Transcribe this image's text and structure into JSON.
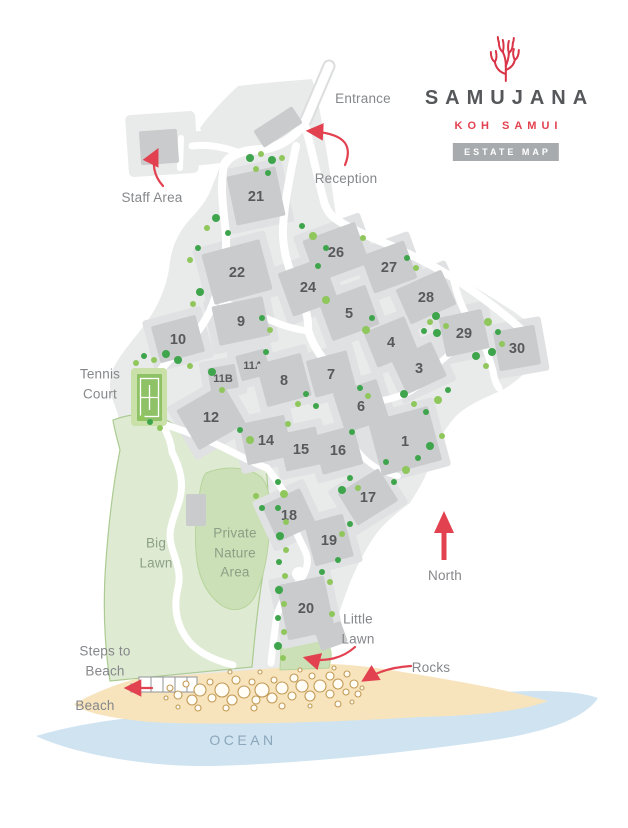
{
  "logo": {
    "brand": "SAMUJANA",
    "location": "KOH SAMUI",
    "badge": "ESTATE MAP"
  },
  "map_labels": {
    "entrance": "Entrance",
    "staff_area": "Staff Area",
    "reception": "Reception",
    "tennis_court": "Tennis Court",
    "big_lawn": "Big Lawn",
    "private_nature_area": "Private Nature Area",
    "little_lawn": "Little Lawn",
    "north": "North",
    "steps_to_beach": "Steps to Beach",
    "beach": "Beach",
    "ocean": "OCEAN",
    "rocks": "Rocks"
  },
  "villas": [
    {
      "number": "21",
      "x": 256,
      "y": 196,
      "w": 50,
      "h": 50,
      "rot": -12
    },
    {
      "number": "22",
      "x": 237,
      "y": 272,
      "w": 60,
      "h": 52,
      "rot": -15
    },
    {
      "number": "26",
      "x": 336,
      "y": 252,
      "w": 56,
      "h": 44,
      "rot": -20
    },
    {
      "number": "27",
      "x": 389,
      "y": 267,
      "w": 46,
      "h": 40,
      "rot": -20
    },
    {
      "number": "24",
      "x": 308,
      "y": 287,
      "w": 48,
      "h": 46,
      "rot": -20
    },
    {
      "number": "28",
      "x": 426,
      "y": 297,
      "w": 50,
      "h": 38,
      "rot": -24
    },
    {
      "number": "5",
      "x": 349,
      "y": 313,
      "w": 50,
      "h": 42,
      "rot": -20
    },
    {
      "number": "9",
      "x": 241,
      "y": 321,
      "w": 52,
      "h": 40,
      "rot": -12
    },
    {
      "number": "10",
      "x": 178,
      "y": 339,
      "w": 46,
      "h": 38,
      "rot": -15
    },
    {
      "number": "4",
      "x": 391,
      "y": 342,
      "w": 44,
      "h": 38,
      "rot": -22
    },
    {
      "number": "29",
      "x": 464,
      "y": 333,
      "w": 44,
      "h": 40,
      "rot": -12
    },
    {
      "number": "30",
      "x": 517,
      "y": 348,
      "w": 42,
      "h": 40,
      "rot": -10
    },
    {
      "number": "11A",
      "x": 253,
      "y": 365,
      "w": 30,
      "h": 26,
      "rot": -15,
      "small": true
    },
    {
      "number": "3",
      "x": 419,
      "y": 368,
      "w": 44,
      "h": 38,
      "rot": -25
    },
    {
      "number": "11B",
      "x": 223,
      "y": 378,
      "w": 28,
      "h": 24,
      "rot": -10,
      "small": true
    },
    {
      "number": "8",
      "x": 284,
      "y": 380,
      "w": 46,
      "h": 44,
      "rot": -15
    },
    {
      "number": "7",
      "x": 331,
      "y": 374,
      "w": 42,
      "h": 38,
      "rot": -15
    },
    {
      "number": "12",
      "x": 211,
      "y": 417,
      "w": 54,
      "h": 46,
      "rot": -30
    },
    {
      "number": "6",
      "x": 361,
      "y": 406,
      "w": 46,
      "h": 42,
      "rot": -18
    },
    {
      "number": "14",
      "x": 266,
      "y": 440,
      "w": 46,
      "h": 42,
      "rot": -12
    },
    {
      "number": "15",
      "x": 301,
      "y": 449,
      "w": 38,
      "h": 38,
      "rot": -12
    },
    {
      "number": "16",
      "x": 338,
      "y": 450,
      "w": 42,
      "h": 40,
      "rot": -15
    },
    {
      "number": "1",
      "x": 405,
      "y": 441,
      "w": 62,
      "h": 56,
      "rot": -15
    },
    {
      "number": "17",
      "x": 368,
      "y": 497,
      "w": 48,
      "h": 38,
      "rot": -32
    },
    {
      "number": "18",
      "x": 289,
      "y": 515,
      "w": 42,
      "h": 40,
      "rot": -25
    },
    {
      "number": "19",
      "x": 329,
      "y": 540,
      "w": 40,
      "h": 44,
      "rot": -15
    },
    {
      "number": "20",
      "x": 306,
      "y": 608,
      "w": 48,
      "h": 56,
      "rot": -12
    }
  ],
  "colors": {
    "accent_red": "#e2414f",
    "coral_red": "#d93448",
    "brand_gray": "#55575a",
    "badge_gray": "#a8abad",
    "estate_gray": "#e9eaea",
    "plot_gray": "#e0e1e2",
    "building_gray": "#c9cbcc",
    "road_white": "#ffffff",
    "tree_dark": "#3ea54c",
    "tree_light": "#8fc75c",
    "tennis_green": "#8fc167",
    "lawn_green": "#dfead3",
    "lawn_border": "#abcb92",
    "nature_green": "#cbe0b6",
    "sand": "#f7e4bd",
    "rock_outline": "#c29a55",
    "ocean_blue": "#cfe3f1",
    "label_gray": "#85878a",
    "lawn_label_green": "#8ba086",
    "ocean_label_blue": "#8ba7bb",
    "number_gray": "#58595c"
  }
}
